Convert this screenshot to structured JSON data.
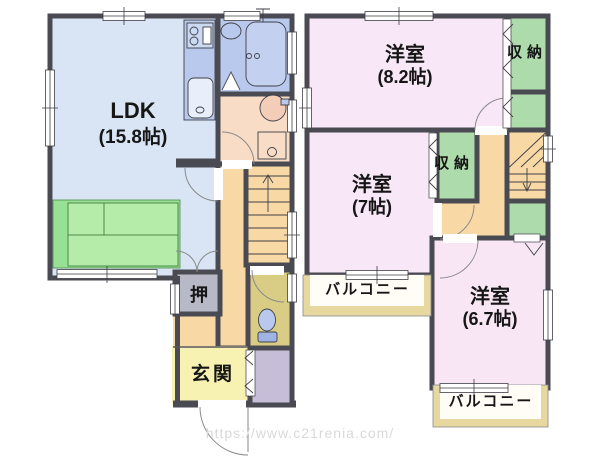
{
  "watermark": "https://www.c21renia.com/",
  "colors": {
    "wall": "#4a4a52",
    "ldk_fill": "#d9e5f5",
    "bath_fill": "#b9c9ee",
    "washroom_fill": "#f8dcc6",
    "hall_fill": "#f8d9a6",
    "genkan_fill": "#f8f2b2",
    "toilet_fill": "#d9cd86",
    "oshiire_fill": "#b7b9c6",
    "shoe_cabinet_fill": "#c6bdd8",
    "bedroom_fill": "#f7e7f7",
    "closet_fill": "#aedbab",
    "balcony_trim": "#e7d8a0",
    "furniture_green": "#98e093"
  },
  "floor1": {
    "ldk": {
      "name": "LDK",
      "size": "(15.8帖)"
    },
    "oshiire": {
      "name": "押"
    },
    "genkan": {
      "name": "玄関"
    }
  },
  "floor2": {
    "bedroom_large": {
      "name": "洋室",
      "size": "(8.2帖)"
    },
    "bedroom_mid": {
      "name": "洋室",
      "size": "(7帖)"
    },
    "bedroom_small": {
      "name": "洋室",
      "size": "(6.7帖)"
    },
    "closet_top": {
      "name": "収納"
    },
    "closet_mid": {
      "name": "収納"
    },
    "balcony_left": {
      "name": "バルコニー"
    },
    "balcony_bottom": {
      "name": "バルコニー"
    }
  }
}
